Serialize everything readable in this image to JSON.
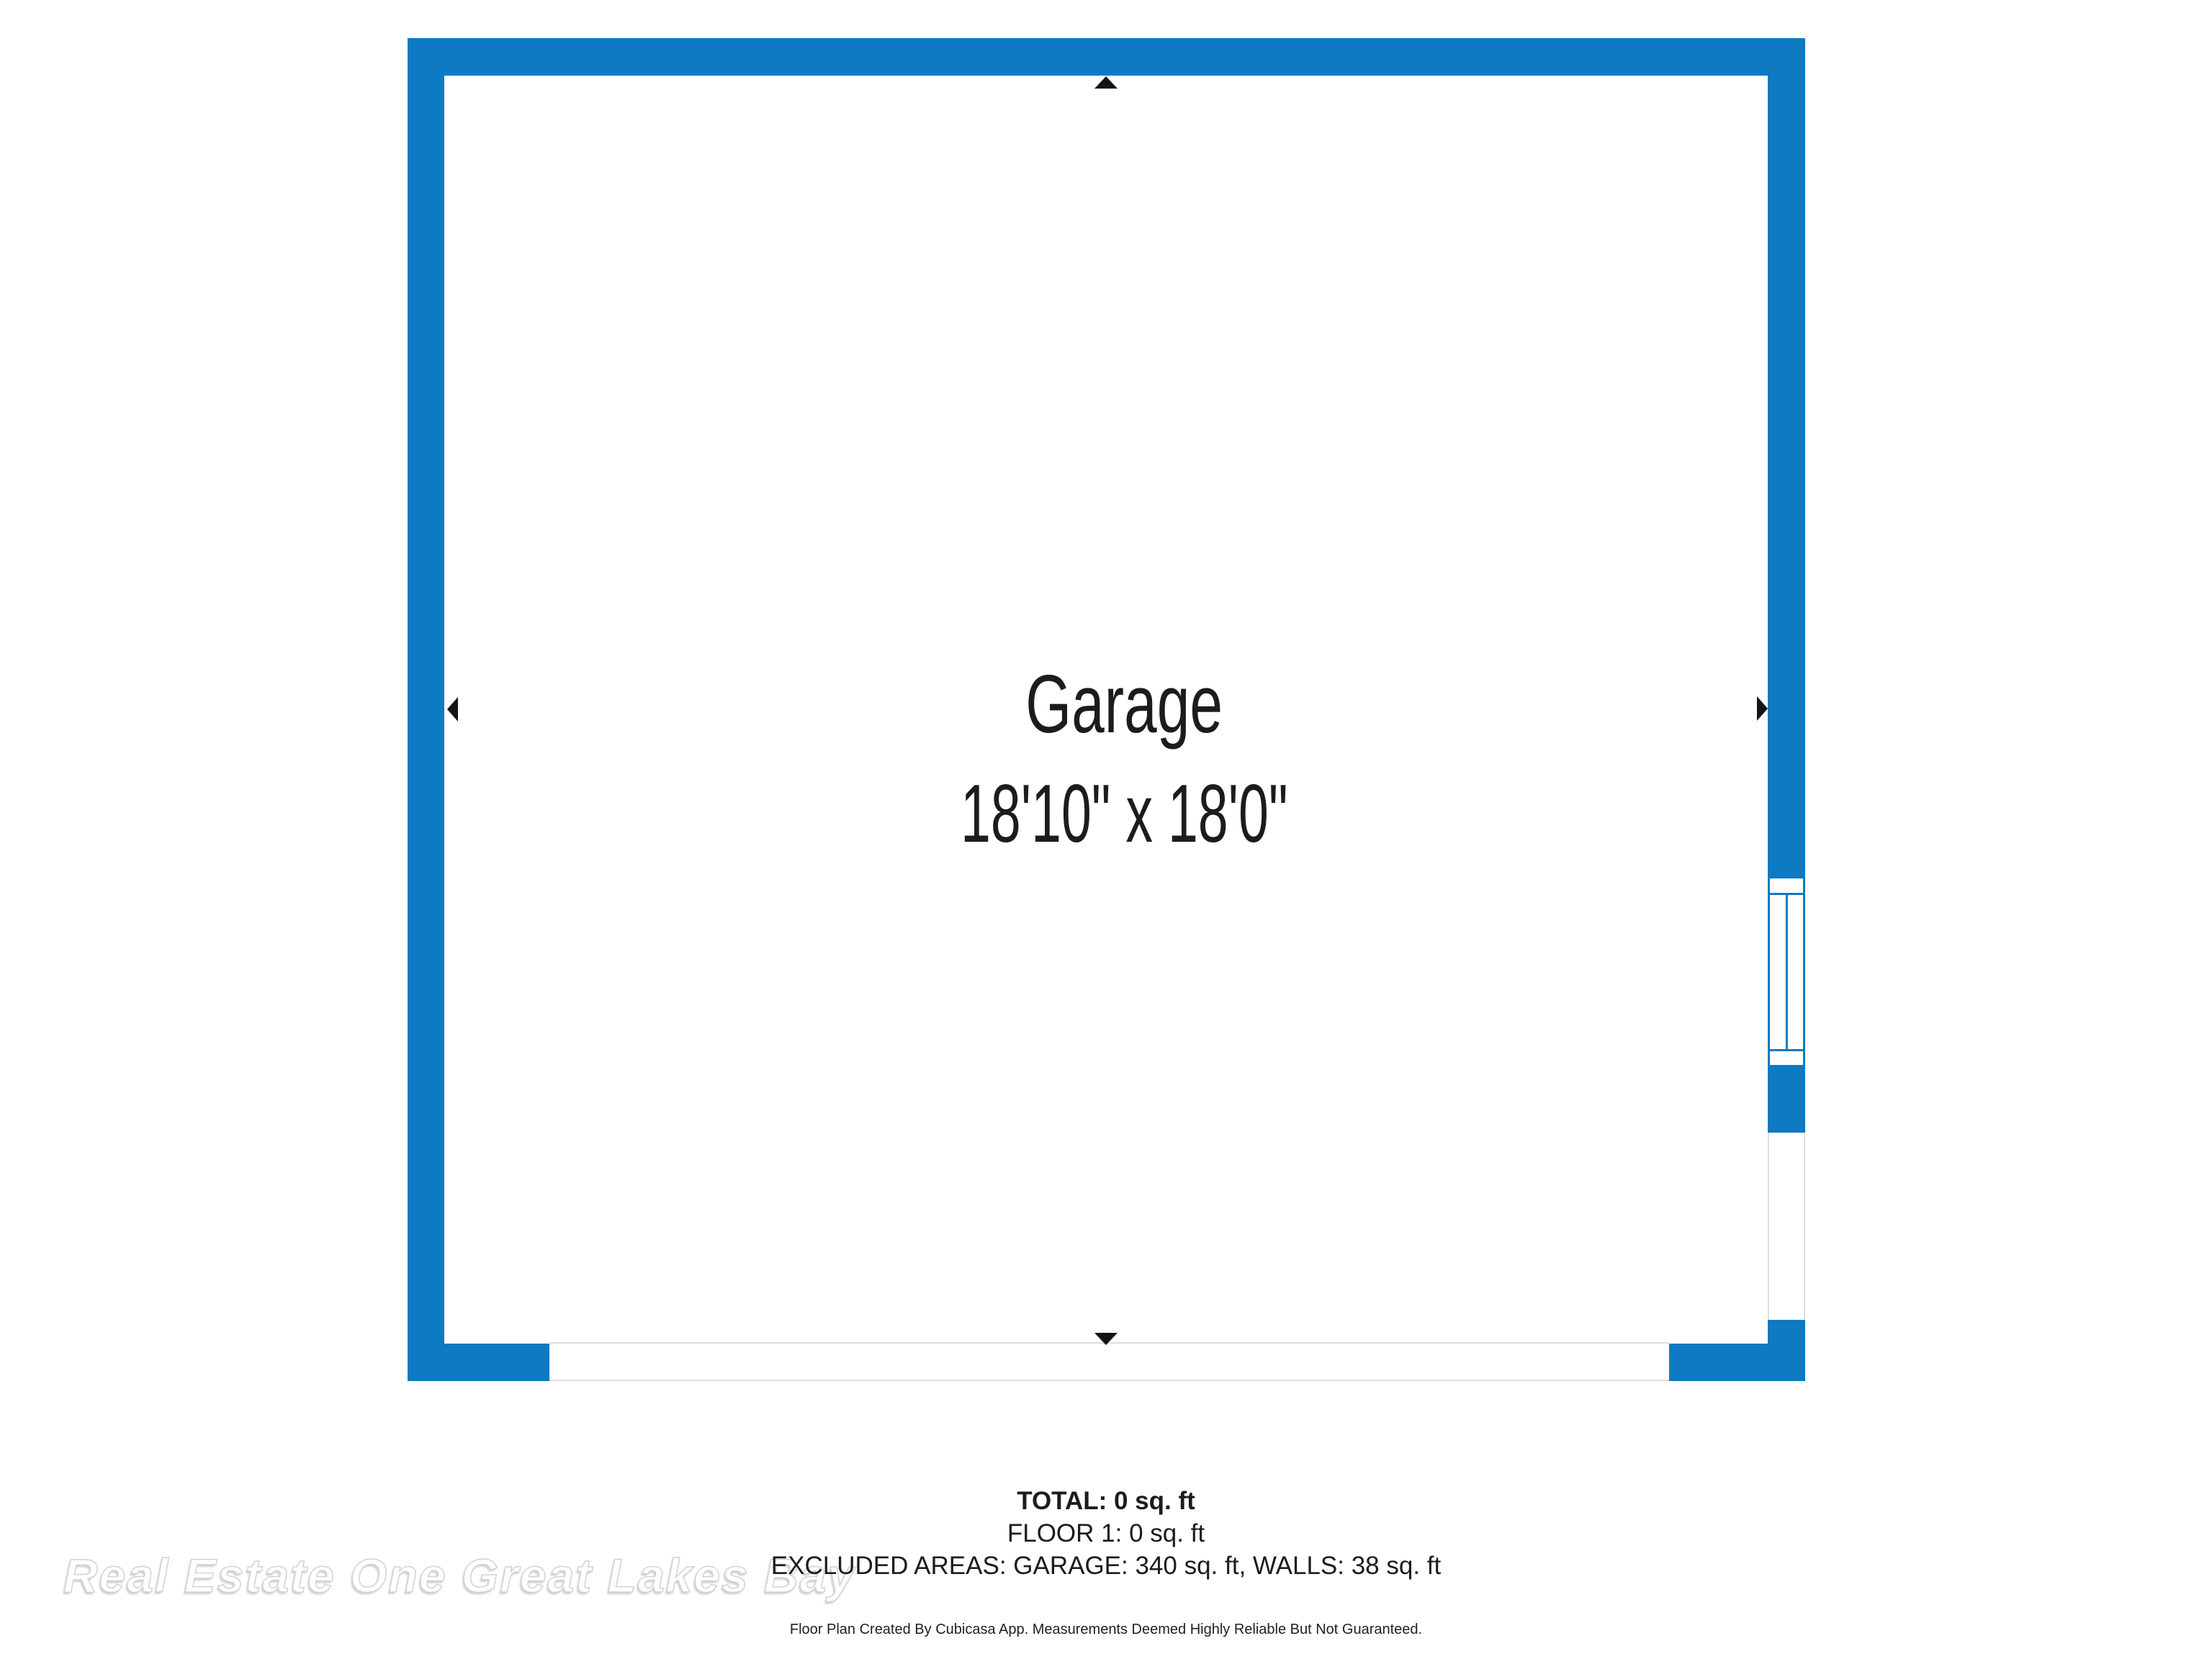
{
  "colors": {
    "wall_blue": "#0d7ac2",
    "opening_line": "#dedede",
    "arrow_black": "#141414",
    "text_dark": "#1c1c1c",
    "watermark_fill": "#ffffff",
    "watermark_stroke": "#d2d2d2"
  },
  "room": {
    "name": "Garage",
    "dimensions": "18'10\" x 18'0\""
  },
  "summary": {
    "total": "TOTAL: 0 sq. ft",
    "floor": "FLOOR 1: 0 sq. ft",
    "excluded": "EXCLUDED AREAS: GARAGE: 340 sq. ft, WALLS: 38 sq. ft"
  },
  "footer": {
    "disclaimer": "Floor Plan Created By Cubicasa App. Measurements Deemed Highly Reliable But Not Guaranteed."
  },
  "watermark": {
    "text": "Real Estate One Great Lakes Bay"
  },
  "icons": {
    "orientation_arrows": [
      "extent-arrow-up",
      "extent-arrow-left",
      "extent-arrow-right",
      "extent-arrow-down"
    ]
  }
}
